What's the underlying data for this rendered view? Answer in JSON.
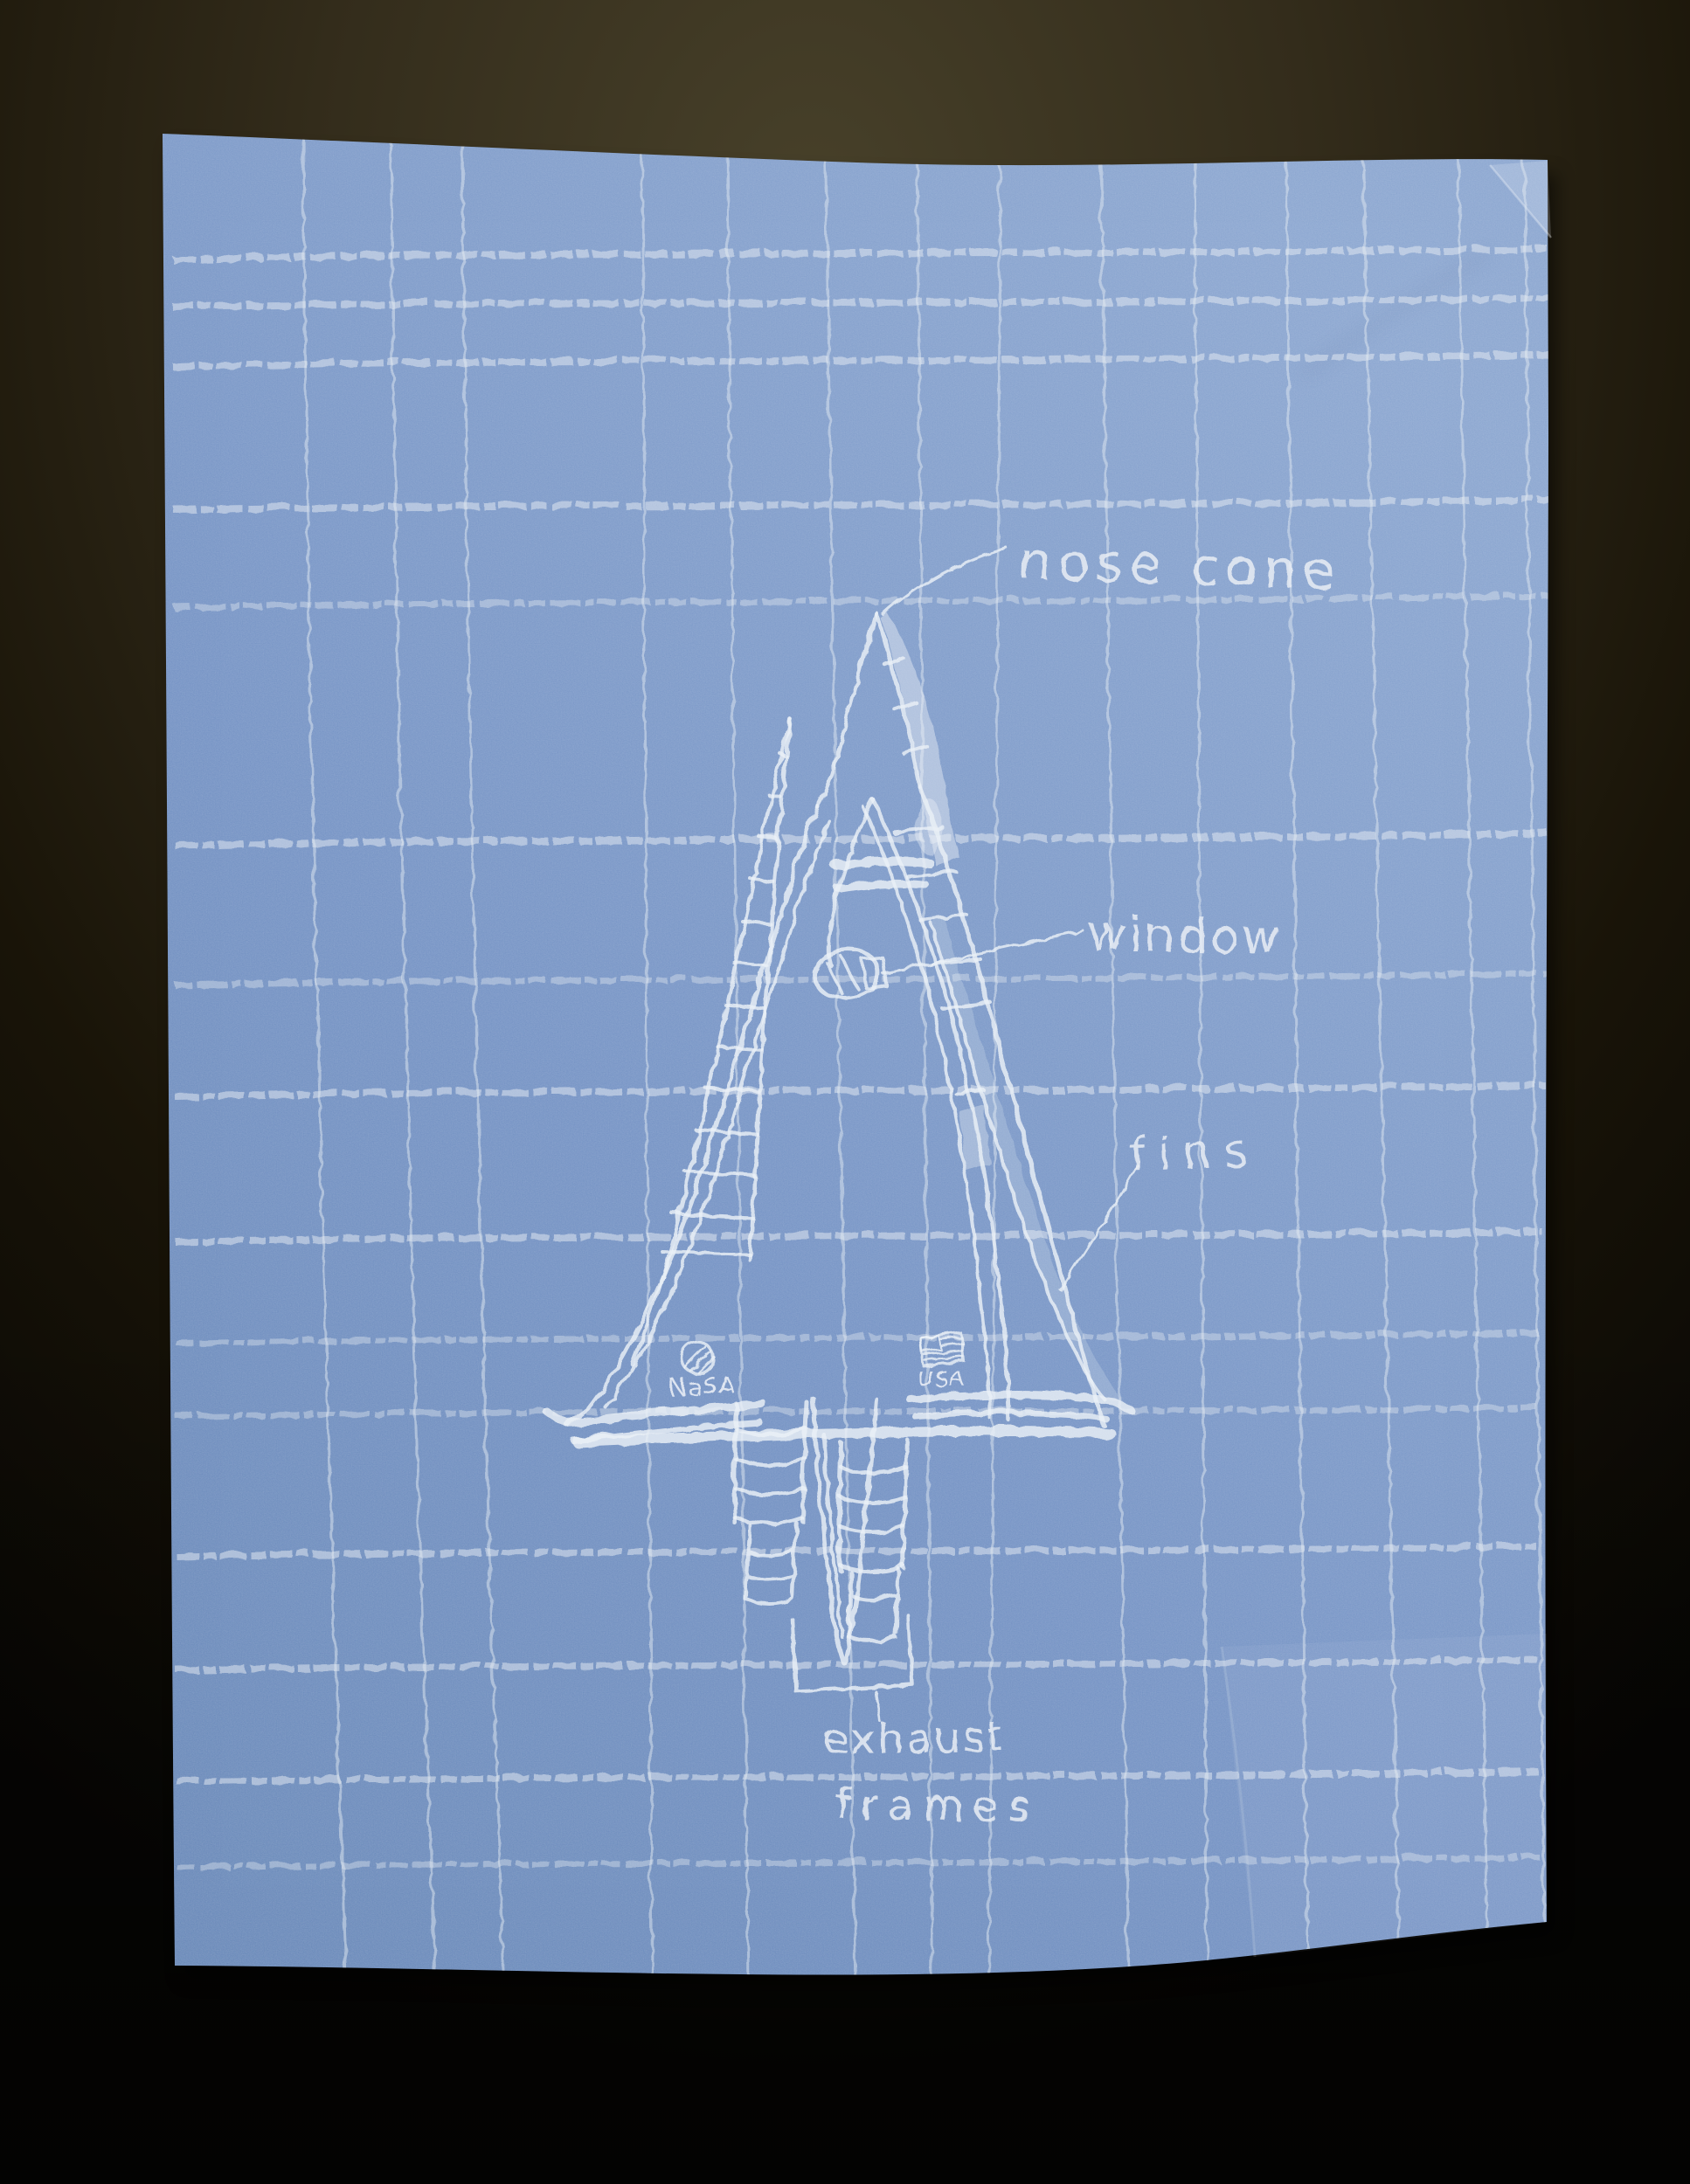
{
  "annotations": {
    "nose_cone": "nose cone",
    "window": "window",
    "fins": "fins",
    "exhaust_frames_line1": "exhaust",
    "exhaust_frames_line2": "frames"
  },
  "rocket_markings": {
    "nasa": "NaSA",
    "usa": "USA"
  },
  "palette": {
    "paper_blue": "#6E8EC3",
    "pencil_chalk_white": "#E9EEF5",
    "background_olive_brown": "#453E26",
    "background_shadow_black": "#0A0805"
  }
}
